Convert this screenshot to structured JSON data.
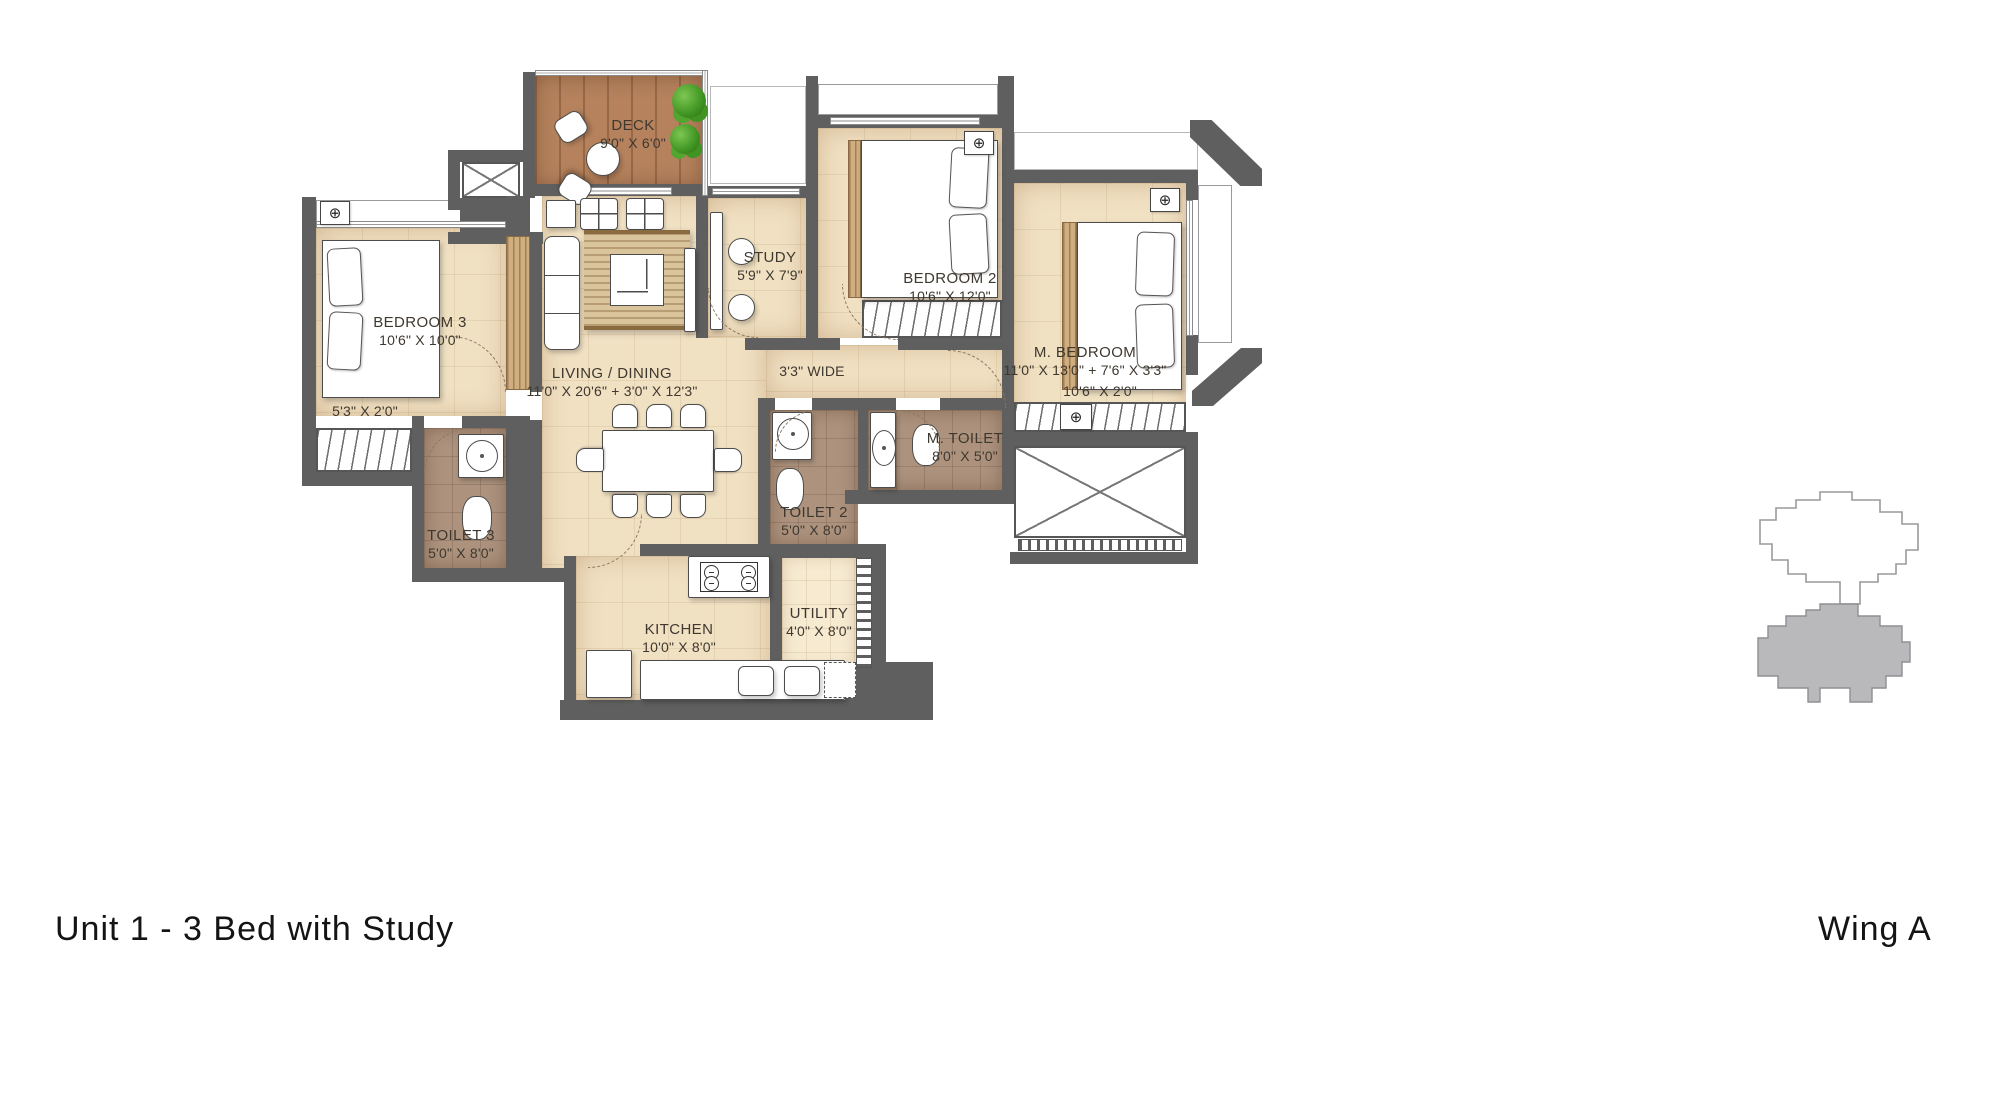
{
  "title": {
    "unit": "Unit 1 - 3 Bed with Study",
    "wing": "Wing A"
  },
  "rooms": {
    "deck": {
      "name": "DECK",
      "dims": "9'0\" X 6'0\""
    },
    "study": {
      "name": "STUDY",
      "dims": "5'9\" X 7'9\""
    },
    "bedroom2": {
      "name": "BEDROOM 2",
      "dims": "10'6\" X 12'0\""
    },
    "m_bedroom": {
      "name": "M. BEDROOM",
      "dims": "11'0\" X 13'0\" + 7'6\" X 3'3\"",
      "wardrobe_dims": "10'6\" X 2'0\""
    },
    "bedroom3": {
      "name": "BEDROOM 3",
      "dims": "10'6\" X 10'0\"",
      "ledge_dims": "5'3\" X 2'0\""
    },
    "living_dining": {
      "name": "LIVING / DINING",
      "dims": "11'0\" X 20'6\" + 3'0\" X 12'3\""
    },
    "passage": {
      "name": "3'3\" WIDE"
    },
    "m_toilet": {
      "name": "M. TOILET",
      "dims": "8'0\" X 5'0\""
    },
    "toilet2": {
      "name": "TOILET 2",
      "dims": "5'0\" X 8'0\""
    },
    "toilet3": {
      "name": "TOILET 3",
      "dims": "5'0\" X 8'0\""
    },
    "kitchen": {
      "name": "KITCHEN",
      "dims": "10'0\" X 8'0\""
    },
    "utility": {
      "name": "UTILITY",
      "dims": "4'0\" X 8'0\""
    }
  },
  "icons": {
    "ac_unit": "⊕"
  },
  "colors": {
    "wall": "#5f5f5f",
    "floor": "#f1e1c3",
    "toilet_floor": "#ad937e",
    "deck_wood": "#b5825d",
    "keyplan_fill": "#b9b9bc",
    "plant_green": "#3f9422"
  }
}
